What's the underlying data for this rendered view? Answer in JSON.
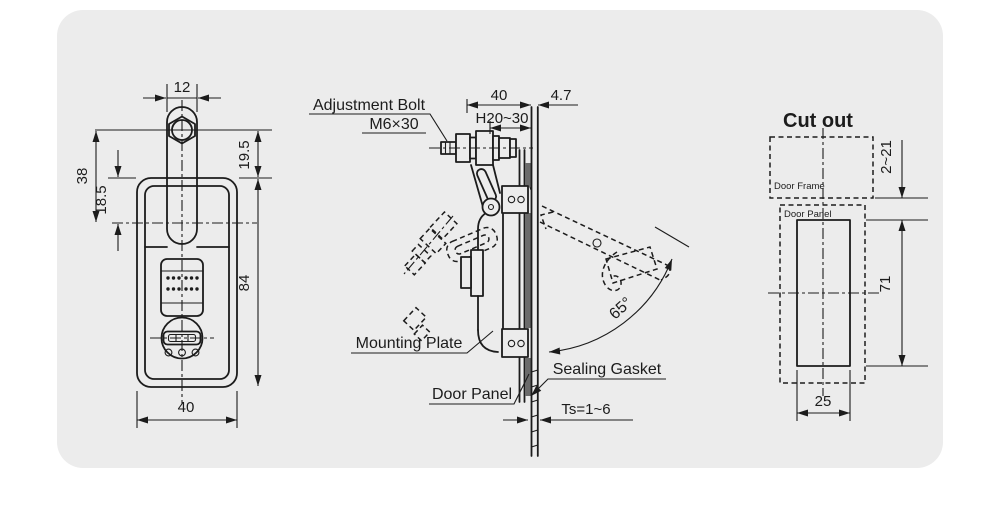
{
  "colors": {
    "page_bg": "#ffffff",
    "card_bg": "#ececec",
    "line": "#1c1c1c",
    "gasket_fill": "#6b6b6b"
  },
  "front": {
    "dim_top_width": "12",
    "dim_38": "38",
    "dim_18_5": "18.5",
    "dim_19_5": "19.5",
    "dim_84": "84",
    "dim_bottom_width": "40"
  },
  "side": {
    "label_adjustment_bolt": "Adjustment Bolt",
    "label_bolt_spec": "M6×30",
    "label_mounting_plate": "Mounting Plate",
    "label_door_panel": "Door Panel",
    "label_sealing_gasket": "Sealing Gasket",
    "dim_depth": "40",
    "dim_4_7": "4.7",
    "dim_grip_range": "H20~30",
    "dim_panel_thickness": "Ts=1~6",
    "dim_open_angle": "65°"
  },
  "cutout": {
    "title": "Cut out",
    "label_door_frame": "Door Frame",
    "label_door_panel": "Door Panel",
    "dim_overlap": "2~21",
    "dim_height": "71",
    "dim_width": "25"
  }
}
